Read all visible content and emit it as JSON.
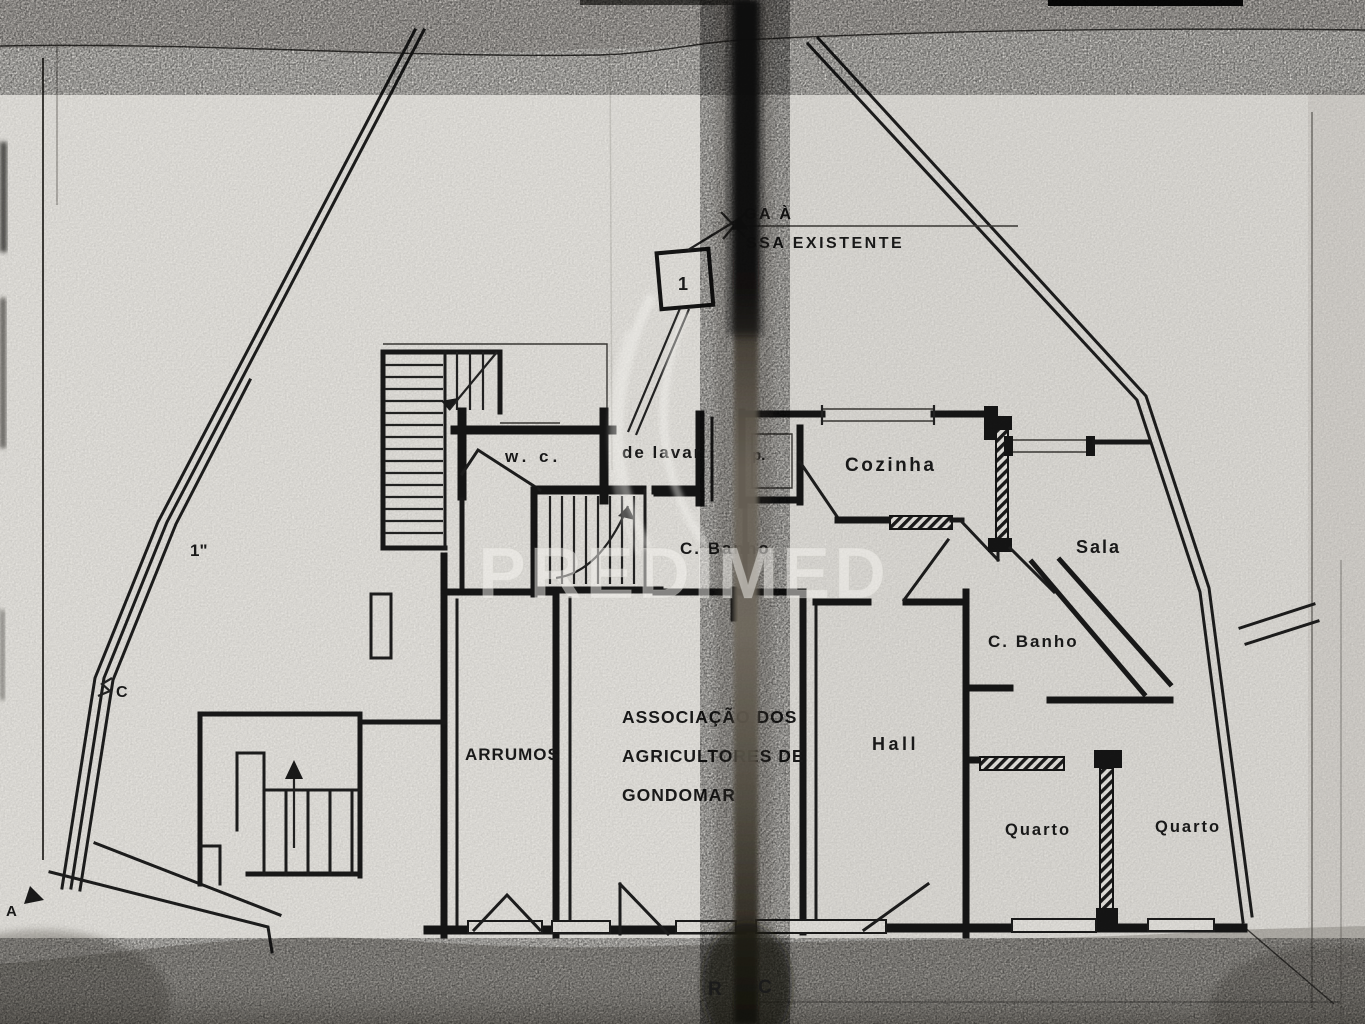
{
  "watermark": {
    "text": "PREDIMED"
  },
  "plan": {
    "floor_label": {
      "left": "R",
      "right": "C"
    },
    "septic_note": {
      "line1": "GA À",
      "line2": "SSA EXISTENTE"
    },
    "pipe_box_label": "1",
    "site_labels": {
      "dimension": "1\"",
      "point_c": "C",
      "point_a": "A"
    },
    "rooms": [
      {
        "id": "wc",
        "label": "w. c."
      },
      {
        "id": "lavar",
        "label": "de lavar"
      },
      {
        "id": "despensa",
        "label": "p."
      },
      {
        "id": "cozinha",
        "label": "Cozinha"
      },
      {
        "id": "sala",
        "label": "Sala"
      },
      {
        "id": "cbanho-centro",
        "label": "C. Banho"
      },
      {
        "id": "cbanho-direita",
        "label": "C. Banho"
      },
      {
        "id": "hall",
        "label": "Hall"
      },
      {
        "id": "arrumos",
        "label": "ARRUMOS"
      },
      {
        "id": "quarto-1",
        "label": "Quarto"
      },
      {
        "id": "quarto-2",
        "label": "Quarto"
      }
    ],
    "association": [
      "ASSOCIAÇÃO DOS",
      "AGRICULTORES DE",
      "GONDOMAR"
    ],
    "colors": {
      "ink": "#1b1b1b",
      "paper": "#e6e4df",
      "fold": "#0b0a08",
      "band": "#b3b0aa"
    }
  }
}
